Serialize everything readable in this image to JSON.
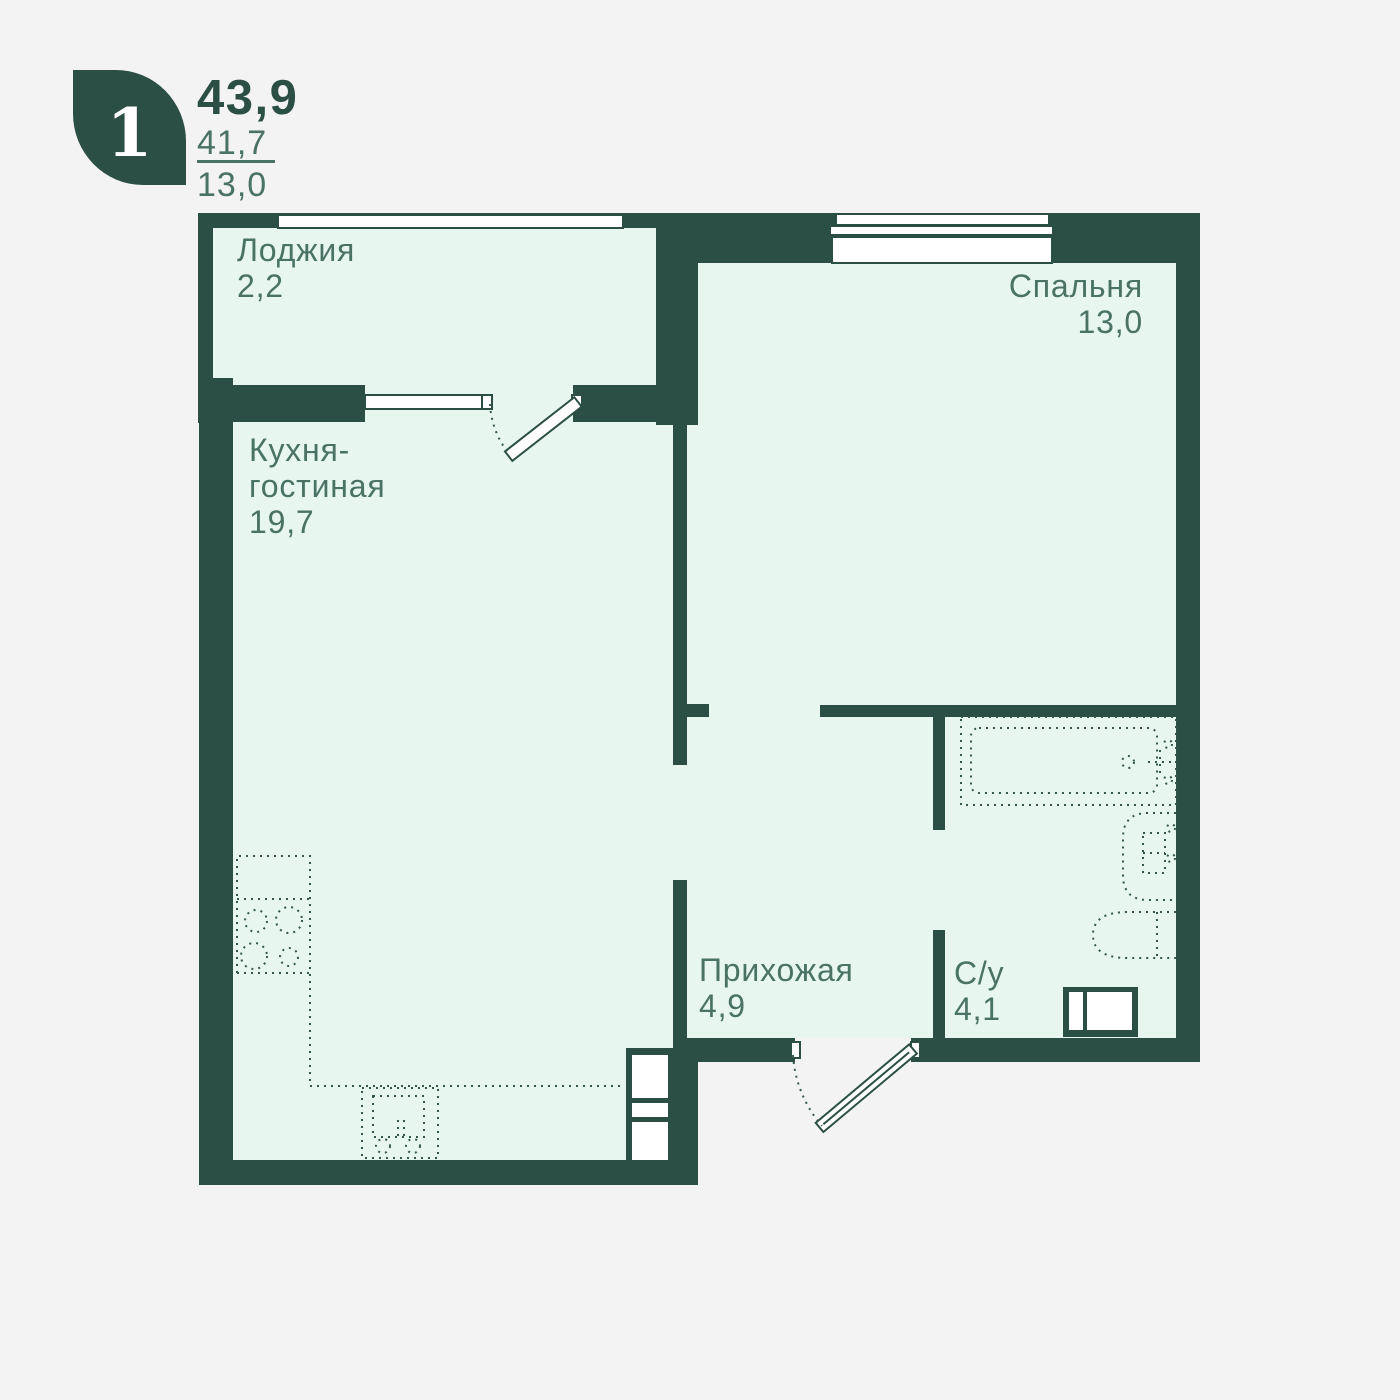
{
  "header": {
    "room_count": "1",
    "total_area": "43,9",
    "living_area": "41,7",
    "kitchen_area": "13,0"
  },
  "rooms": {
    "loggia": {
      "name": "Лоджия",
      "area": "2,2"
    },
    "kitchen_living": {
      "name_line1": "Кухня-",
      "name_line2": "гостиная",
      "area": "19,7"
    },
    "bedroom": {
      "name": "Спальня",
      "area": "13,0"
    },
    "hallway": {
      "name": "Прихожая",
      "area": "4,9"
    },
    "bathroom": {
      "name": "С/у",
      "area": "4,1"
    }
  },
  "colors": {
    "wall": "#2b4f44",
    "floor": "#e7f7f0",
    "background": "#f2f3f2",
    "label": "#4a7265",
    "accent_white": "#ffffff"
  }
}
